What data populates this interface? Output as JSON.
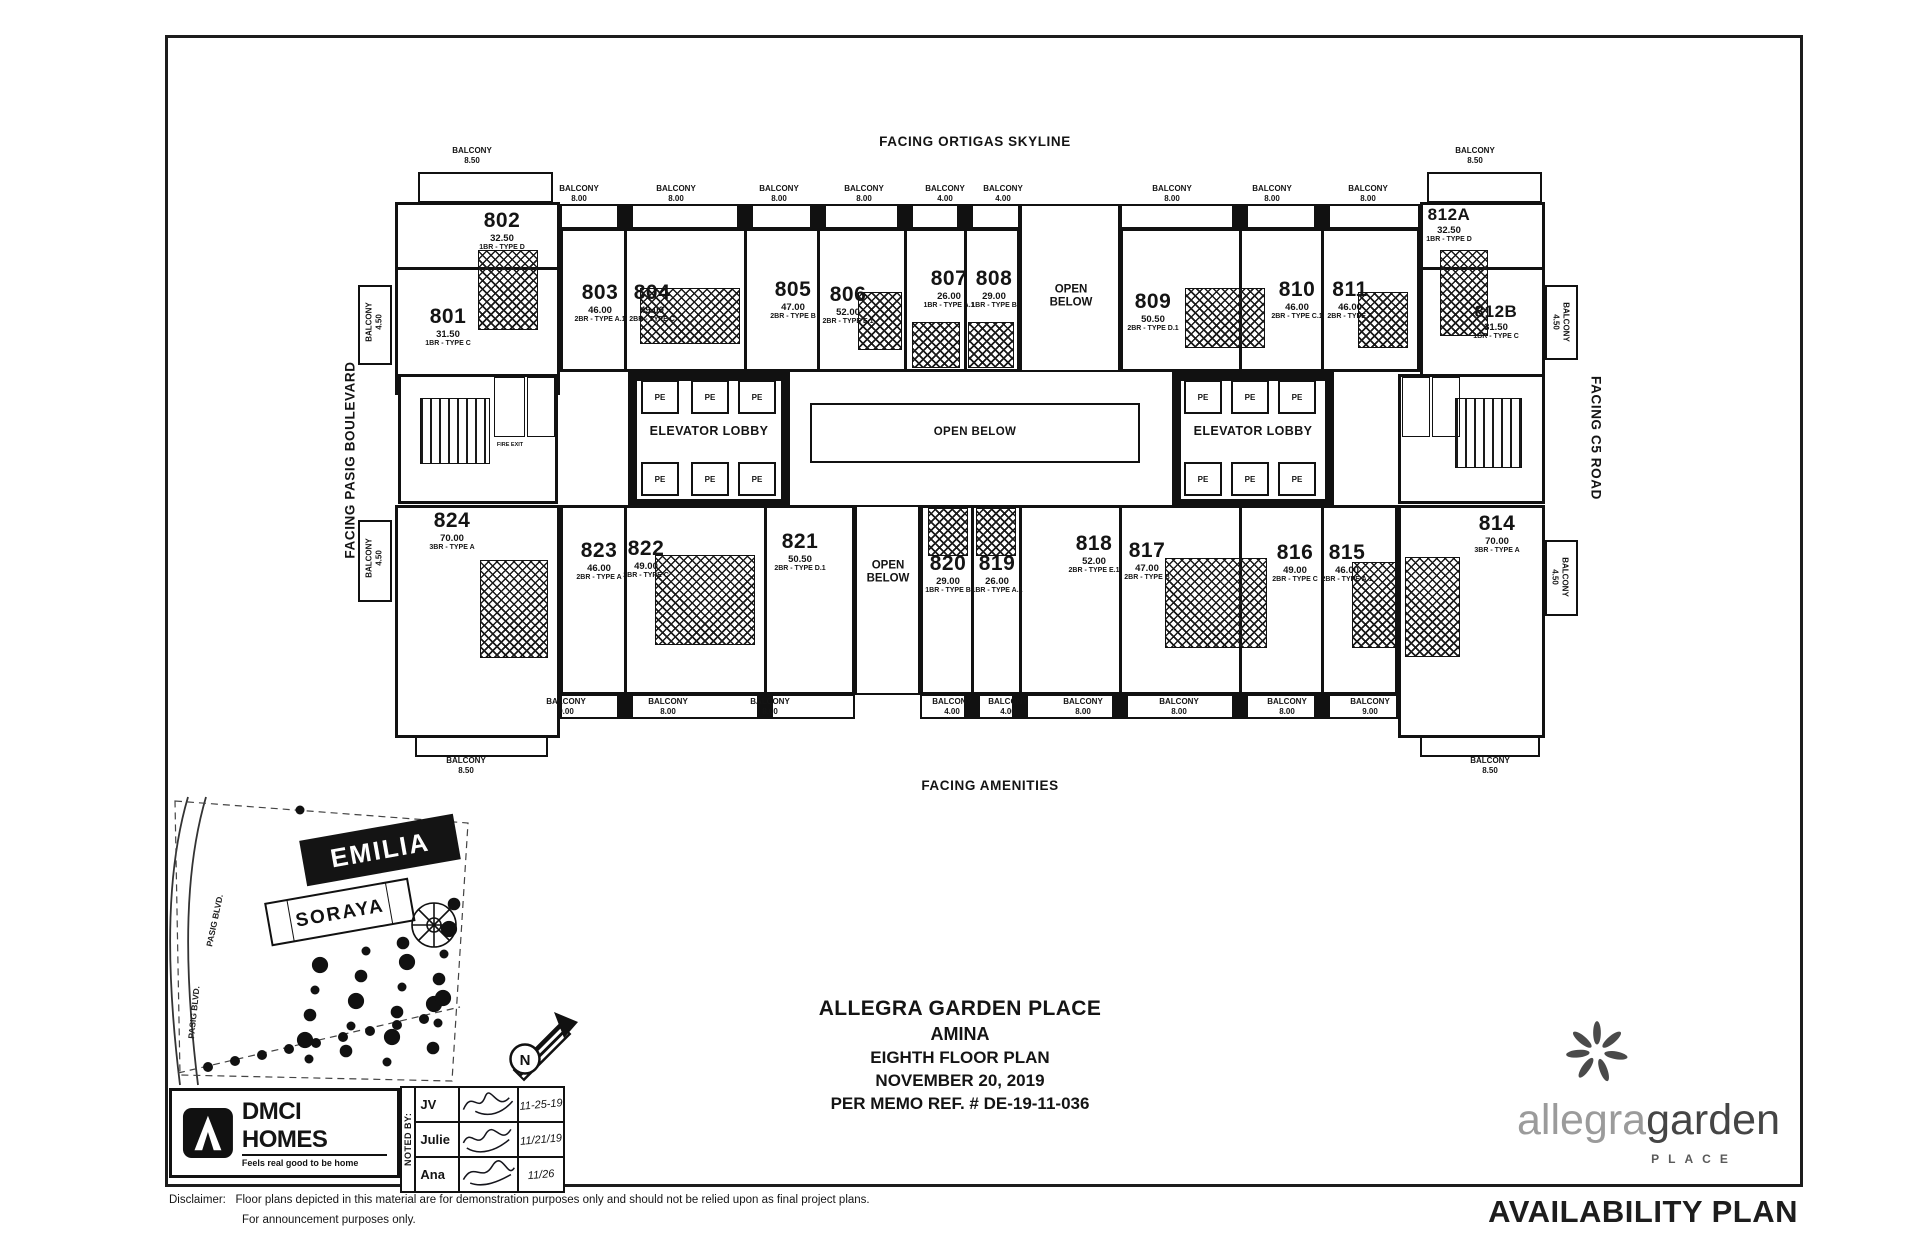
{
  "plan": {
    "facing": {
      "top": "FACING ORTIGAS SKYLINE",
      "left": "FACING PASIG BOULEVARD",
      "right": "FACING C5 ROAD",
      "bottom": "FACING AMENITIES"
    },
    "labels": {
      "balcony": "BALCONY",
      "open_below": "OPEN BELOW",
      "open": "OPEN",
      "below": "BELOW",
      "elevator_lobby": "ELEVATOR LOBBY",
      "pe": "PE",
      "fire_exit": "FIRE EXIT"
    },
    "units": [
      {
        "id": "801",
        "area": "31.50",
        "type": "1BR - TYPE C"
      },
      {
        "id": "802",
        "area": "32.50",
        "type": "1BR - TYPE D"
      },
      {
        "id": "803",
        "area": "46.00",
        "type": "2BR - TYPE A.1"
      },
      {
        "id": "804",
        "area": "49.00",
        "type": "2BR - TYPE C"
      },
      {
        "id": "805",
        "area": "47.00",
        "type": "2BR - TYPE B"
      },
      {
        "id": "806",
        "area": "52.00",
        "type": "2BR - TYPE E.1"
      },
      {
        "id": "807",
        "area": "26.00",
        "type": "1BR - TYPE A.1"
      },
      {
        "id": "808",
        "area": "29.00",
        "type": "1BR - TYPE B"
      },
      {
        "id": "809",
        "area": "50.50",
        "type": "2BR - TYPE D.1"
      },
      {
        "id": "810",
        "area": "46.00",
        "type": "2BR - TYPE C.1"
      },
      {
        "id": "811",
        "area": "46.00",
        "type": "2BR - TYPE A"
      },
      {
        "id": "812A",
        "area": "32.50",
        "type": "1BR - TYPE D"
      },
      {
        "id": "812B",
        "area": "31.50",
        "type": "1BR - TYPE C"
      },
      {
        "id": "814",
        "area": "70.00",
        "type": "3BR - TYPE A"
      },
      {
        "id": "815",
        "area": "46.00",
        "type": "2BR - TYPE A.1"
      },
      {
        "id": "816",
        "area": "49.00",
        "type": "2BR - TYPE C"
      },
      {
        "id": "817",
        "area": "47.00",
        "type": "2BR - TYPE B"
      },
      {
        "id": "818",
        "area": "52.00",
        "type": "2BR - TYPE E.1"
      },
      {
        "id": "819",
        "area": "26.00",
        "type": "1BR - TYPE A.1"
      },
      {
        "id": "820",
        "area": "29.00",
        "type": "1BR - TYPE B"
      },
      {
        "id": "821",
        "area": "50.50",
        "type": "2BR - TYPE D.1"
      },
      {
        "id": "822",
        "area": "49.00",
        "type": "2BR - TYPE C"
      },
      {
        "id": "823",
        "area": "46.00",
        "type": "2BR - TYPE A"
      },
      {
        "id": "824",
        "area": "70.00",
        "type": "3BR - TYPE A"
      }
    ],
    "balconies": {
      "top": [
        "8.50",
        "8.00",
        "8.00",
        "8.00",
        "8.00",
        "4.00",
        "4.00",
        "8.00",
        "8.00",
        "8.00",
        "8.50"
      ],
      "bottom": [
        "8.50",
        "9.00",
        "8.00",
        "8.00",
        "4.00",
        "4.00",
        "8.00",
        "8.00",
        "8.00",
        "9.00",
        "8.50"
      ],
      "sides": [
        "4.50",
        "4.50",
        "4.50",
        "4.50"
      ]
    }
  },
  "site_map": {
    "buildings": [
      "EMILIA",
      "SORAYA"
    ],
    "road": "PASIG BLVD.",
    "compass": "N"
  },
  "title_block": {
    "project": "ALLEGRA GARDEN PLACE",
    "tower": "AMINA",
    "floor": "EIGHTH FLOOR PLAN",
    "date": "NOVEMBER 20, 2019",
    "memo": "PER MEMO REF. # DE-19-11-036"
  },
  "dmci": {
    "name": "DMCI HOMES",
    "tagline": "Feels real good to be home"
  },
  "noted_by": {
    "label": "NOTED BY:",
    "rows": [
      {
        "name": "JV",
        "date": "11-25-19"
      },
      {
        "name": "Julie",
        "date": "11/21/19"
      },
      {
        "name": "Ana",
        "date": "11/26"
      }
    ]
  },
  "disclaimer": {
    "label": "Disclaimer:",
    "line1": "Floor plans depicted in this material are for demonstration purposes only and should not be relied upon as final project plans.",
    "line2": "For announcement purposes only."
  },
  "branding": {
    "name1": "allegra",
    "name2": "garden",
    "sub": "PLACE"
  },
  "availability": "AVAILABILITY PLAN"
}
